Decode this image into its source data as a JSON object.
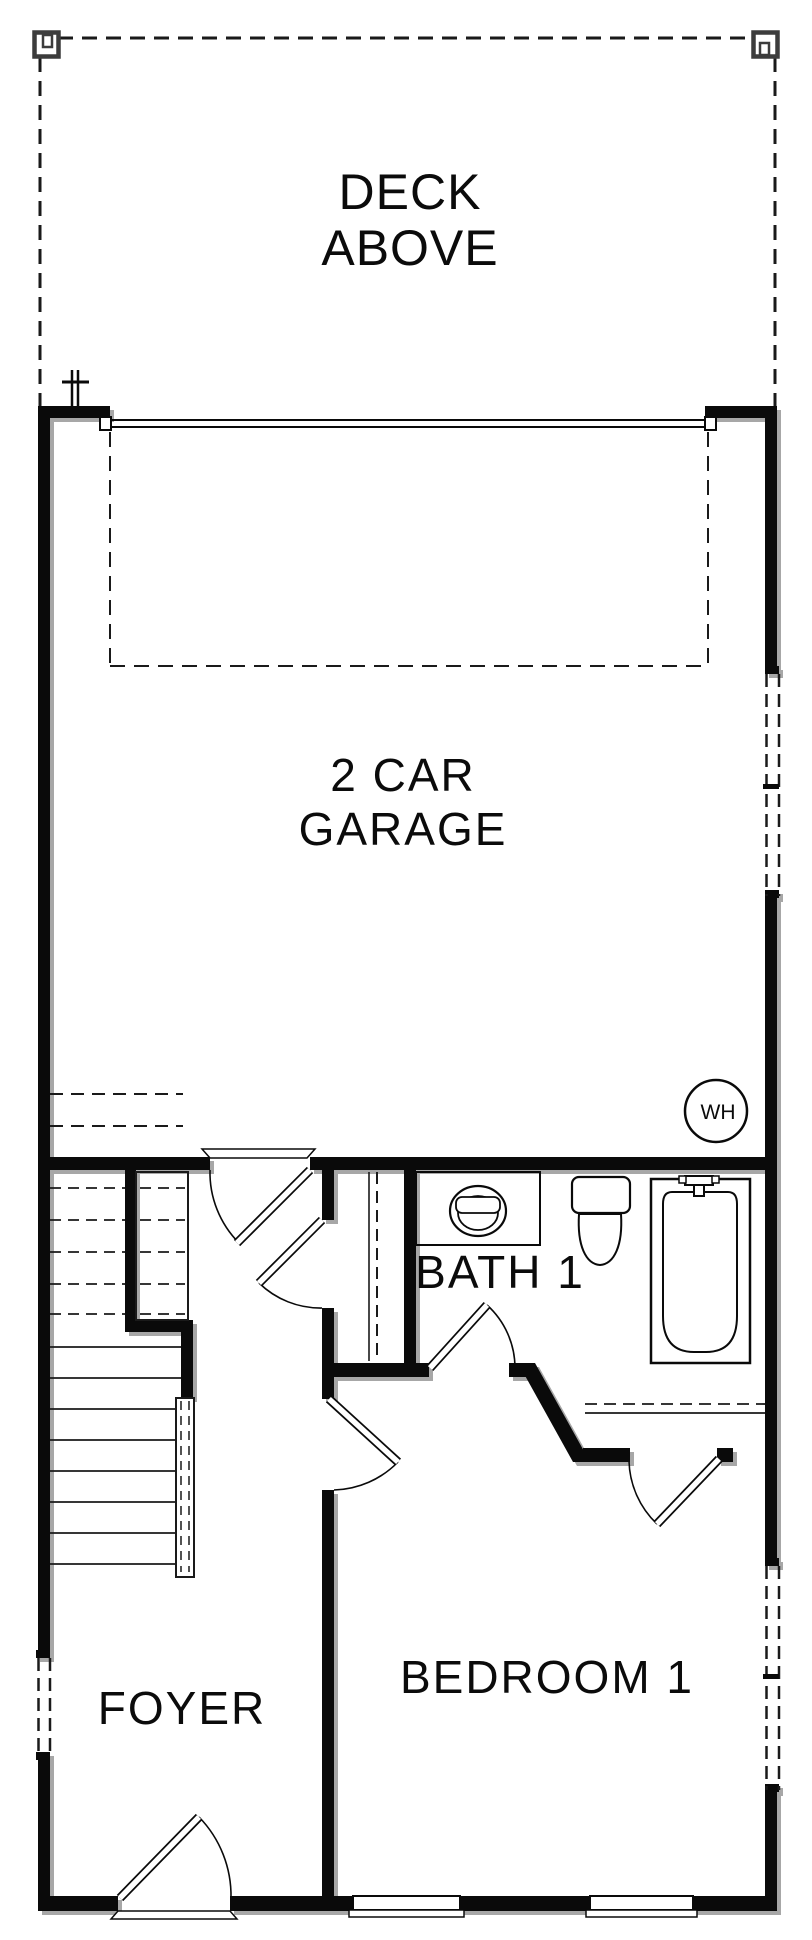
{
  "floor_plan": {
    "labels": {
      "deck": {
        "line1": "DECK",
        "line2": "ABOVE"
      },
      "garage": {
        "line1": "2 CAR",
        "line2": "GARAGE"
      },
      "bath": "BATH 1",
      "bedroom": "BEDROOM 1",
      "foyer": "FOYER",
      "water_heater": "WH"
    },
    "colors": {
      "background": "#ffffff",
      "wall": "#0a0a0a",
      "line": "#0a0a0a",
      "post_gray": "#3c3c3c",
      "shadow": "#5f5f5f"
    }
  }
}
